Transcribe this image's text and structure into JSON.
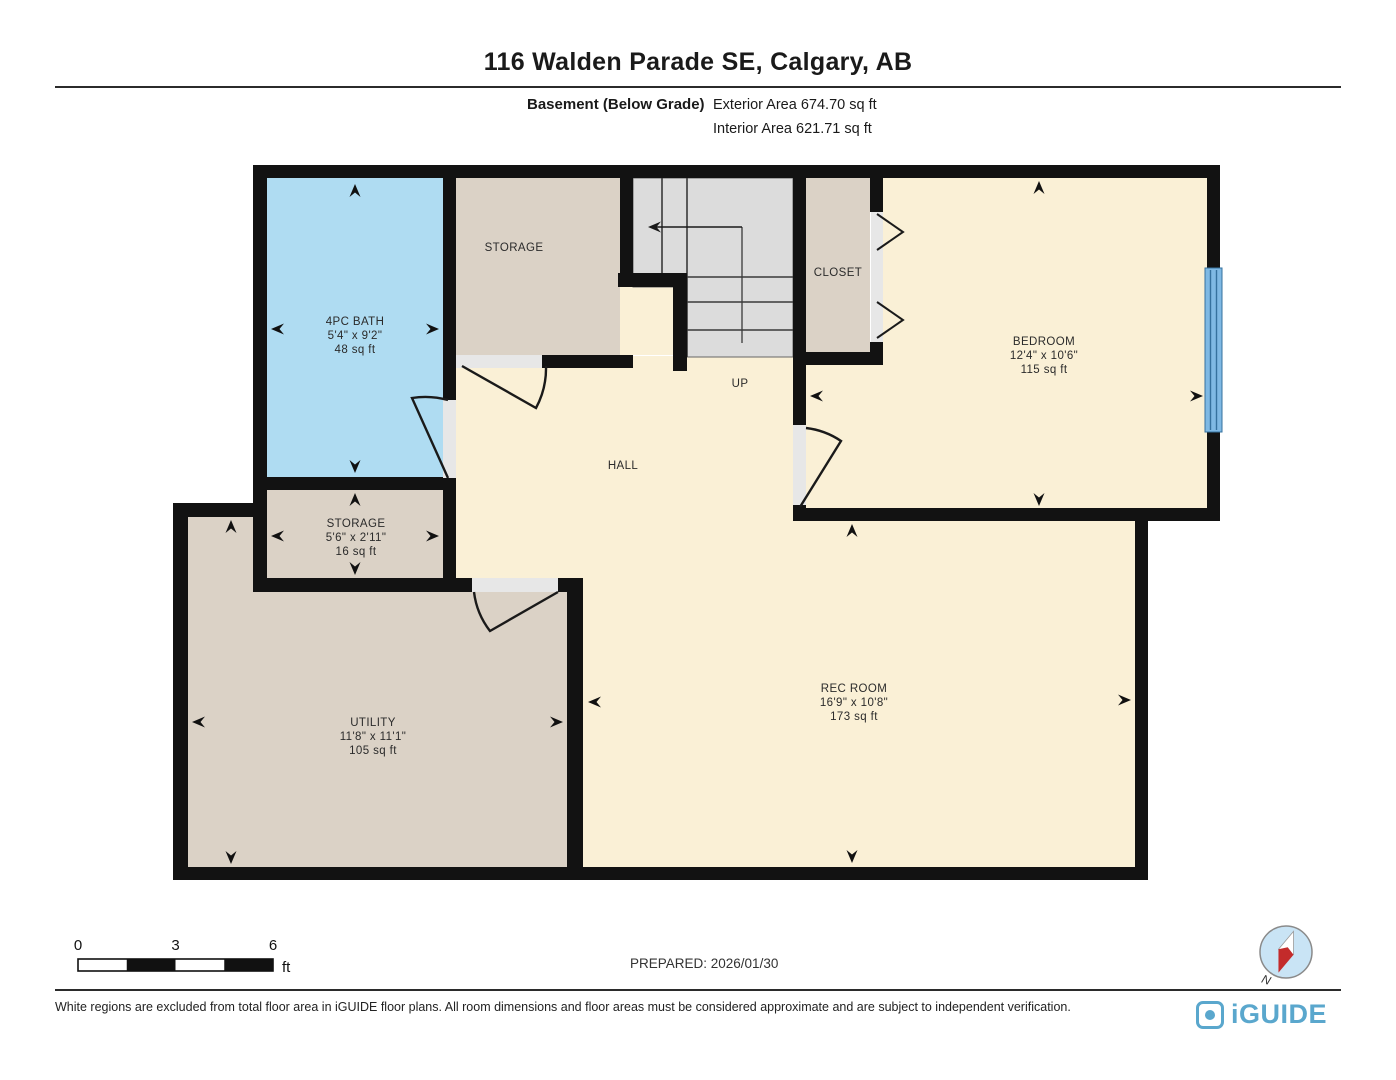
{
  "header": {
    "title": "116 Walden Parade SE, Calgary, AB",
    "floor_label": "Basement (Below Grade)",
    "exterior_area": "Exterior Area 674.70 sq ft",
    "interior_area": "Interior Area 621.71 sq ft"
  },
  "plan": {
    "rooms": {
      "bath": {
        "name": "4PC BATH",
        "dims": "5'4\" x 9'2\"",
        "area": "48 sq ft"
      },
      "storage_top": {
        "name": "STORAGE"
      },
      "closet": {
        "name": "CLOSET"
      },
      "bedroom": {
        "name": "BEDROOM",
        "dims": "12'4\" x 10'6\"",
        "area": "115 sq ft"
      },
      "hall": {
        "name": "HALL"
      },
      "stairs": {
        "direction_label": "UP"
      },
      "storage_lower": {
        "name": "STORAGE",
        "dims": "5'6\" x 2'11\"",
        "area": "16 sq ft"
      },
      "utility": {
        "name": "UTILITY",
        "dims": "11'8\" x 11'1\"",
        "area": "105 sq ft"
      },
      "rec_room": {
        "name": "REC ROOM",
        "dims": "16'9\" x 10'8\"",
        "area": "173 sq ft"
      }
    },
    "colors": {
      "bath": "#AFDCF2",
      "tan": "#DBD2C6",
      "cream": "#FAF0D6",
      "stairs": "#DCDCDC",
      "wall": "#121212",
      "threshold": "#E7E7E7",
      "window": "#7FB9E4",
      "compass_fill": "#C9E4F5",
      "needle_red": "#C32B2B",
      "brand_blue": "#5AA7CD"
    }
  },
  "footer": {
    "scale": {
      "tick0": "0",
      "tick1": "3",
      "tick2": "6",
      "unit": "ft"
    },
    "prepared": "PREPARED: 2026/01/30",
    "compass_north_label": "N",
    "disclaimer": "White regions are excluded from total floor area in iGUIDE floor plans. All room dimensions and floor areas must be considered approximate and are subject to independent verification.",
    "brand": "iGUIDE"
  }
}
